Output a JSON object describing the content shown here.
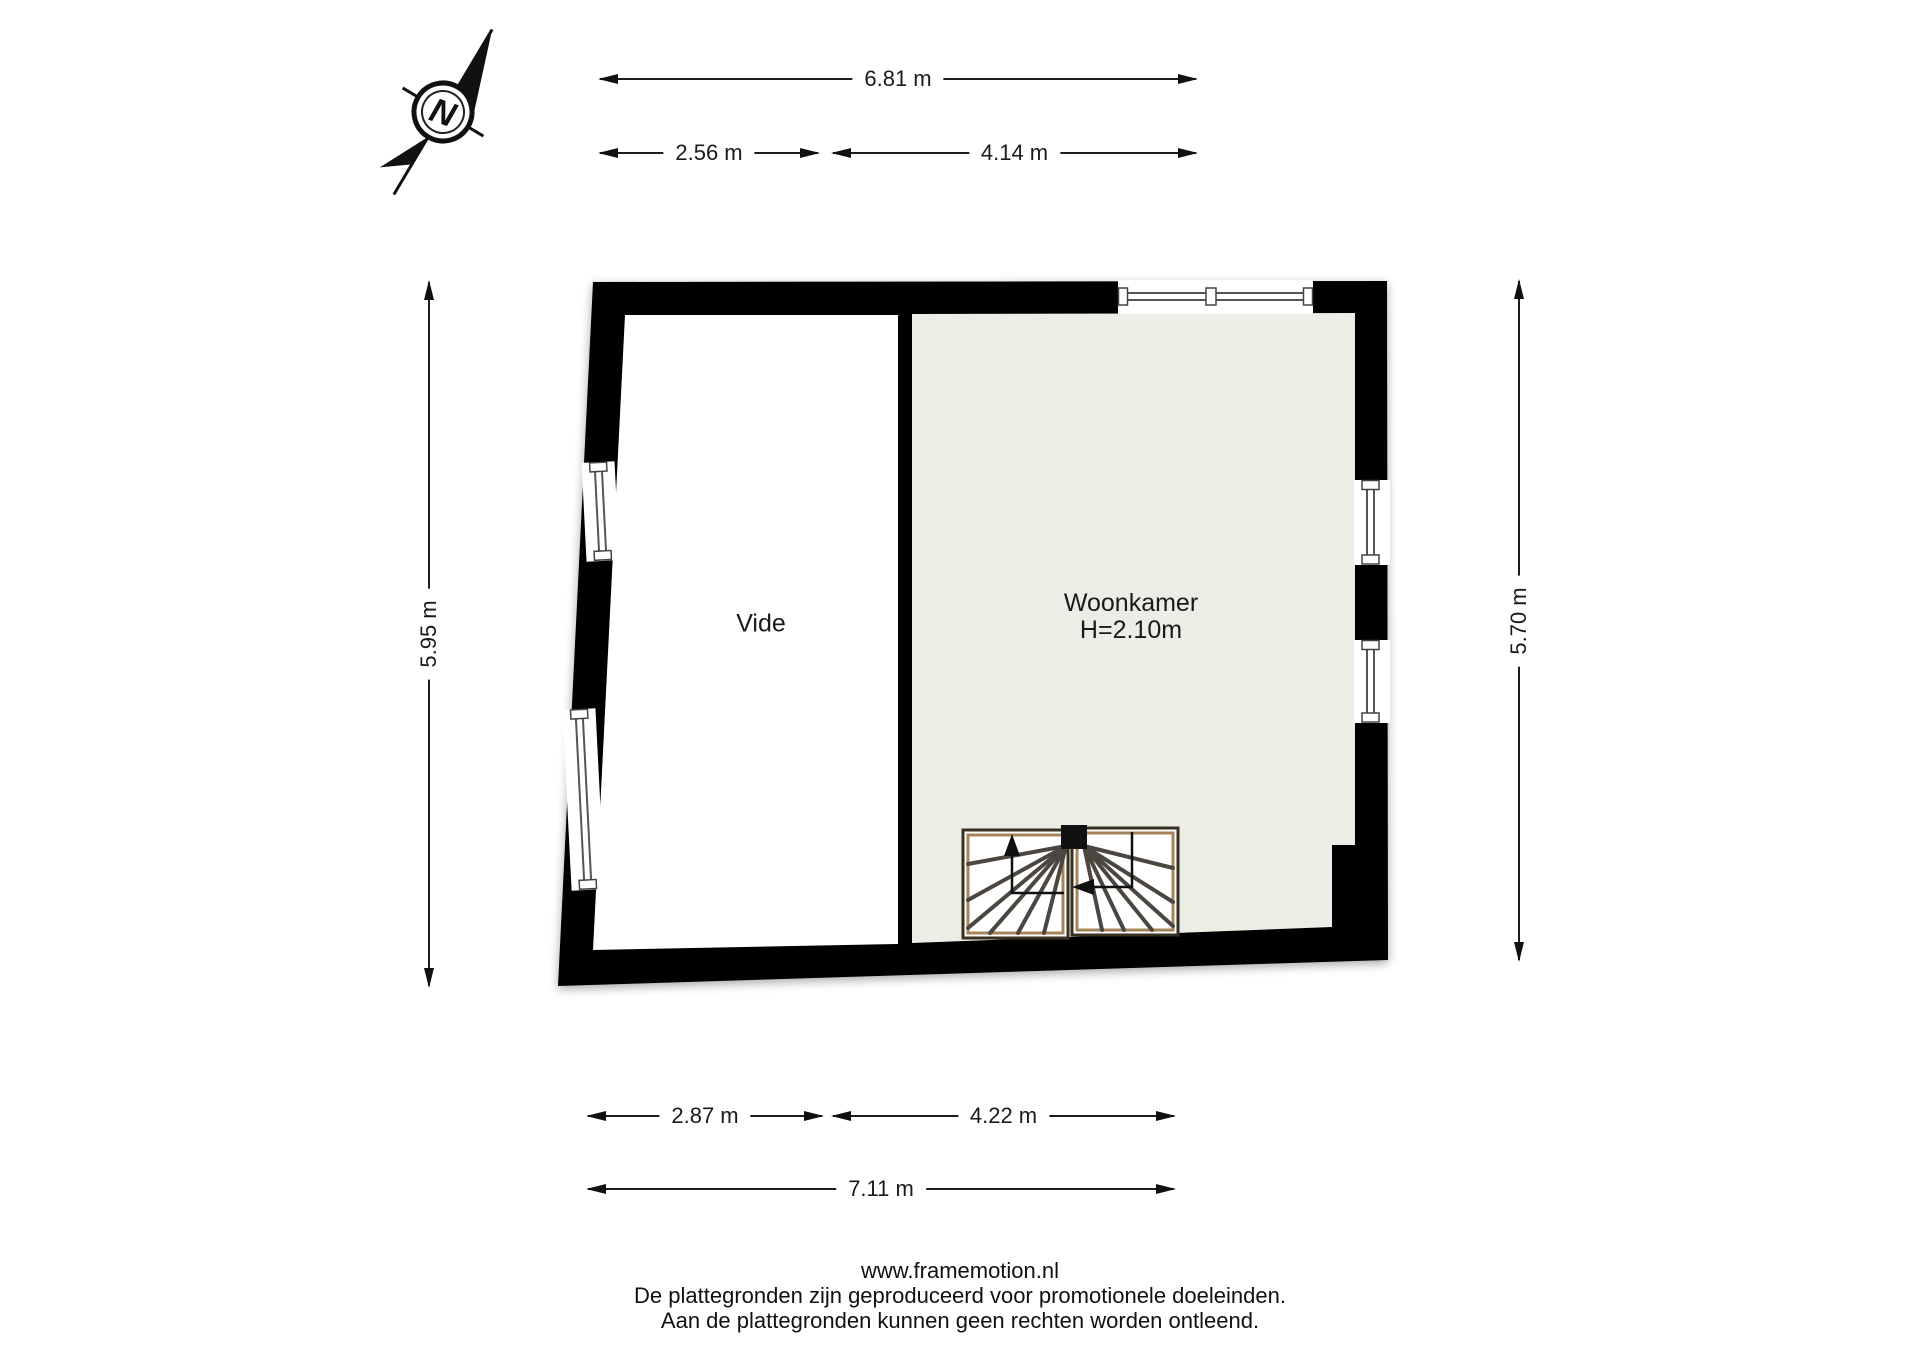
{
  "compass": {
    "label": "N"
  },
  "dimensions": {
    "top_total": "6.81 m",
    "top_left": "2.56 m",
    "top_right": "4.14 m",
    "left_side": "5.95 m",
    "right_side": "5.70 m",
    "bottom_left": "2.87 m",
    "bottom_right": "4.22 m",
    "bottom_total": "7.11 m"
  },
  "rooms": {
    "vide": {
      "name": "Vide"
    },
    "woonkamer": {
      "name": "Woonkamer",
      "ceiling_height": "H=2.10m"
    }
  },
  "footer": {
    "line1": "www.framemotion.nl",
    "line2": "De plattegronden zijn geproduceerd voor promotionele doeleinden.",
    "line3": "Aan de plattegronden kunnen geen rechten worden ontleend."
  },
  "colors": {
    "wall": "#000000",
    "vide_floor": "#ffffff",
    "woonkamer_floor": "#ECEDE5",
    "stair_frame_dark": "#3a3020",
    "stair_frame_tan": "#a5845c",
    "window_line": "#555555"
  }
}
